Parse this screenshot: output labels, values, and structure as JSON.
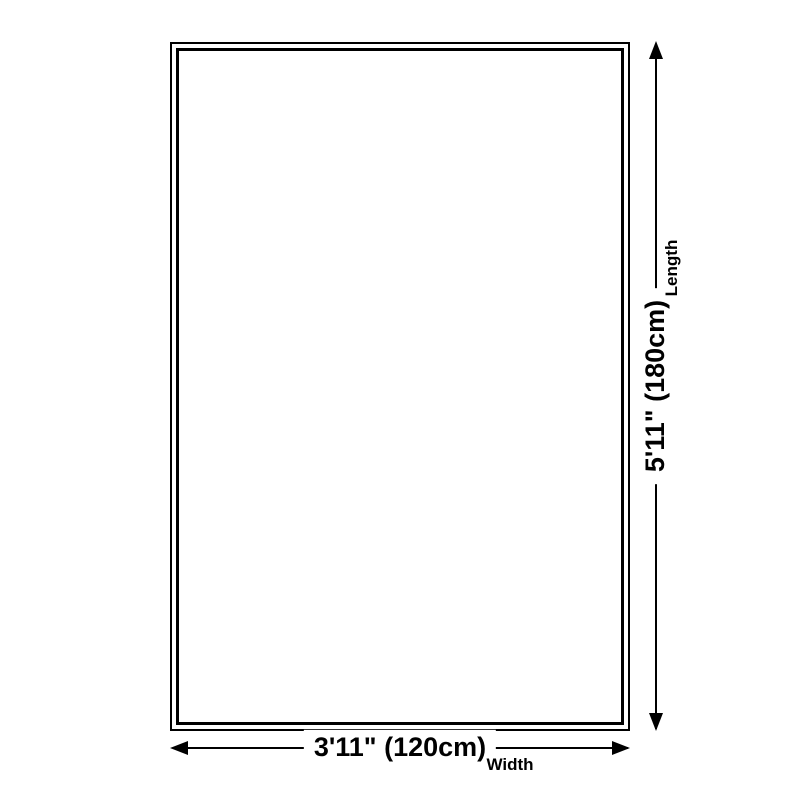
{
  "page": {
    "background_color": "#ffffff",
    "line_color": "#000000"
  },
  "diagram": {
    "type": "rug-dimension-diagram",
    "length": {
      "value": "5'11\" (180cm)",
      "label": "Length"
    },
    "width": {
      "value": "3'11\" (120cm)",
      "label": "Width"
    }
  }
}
